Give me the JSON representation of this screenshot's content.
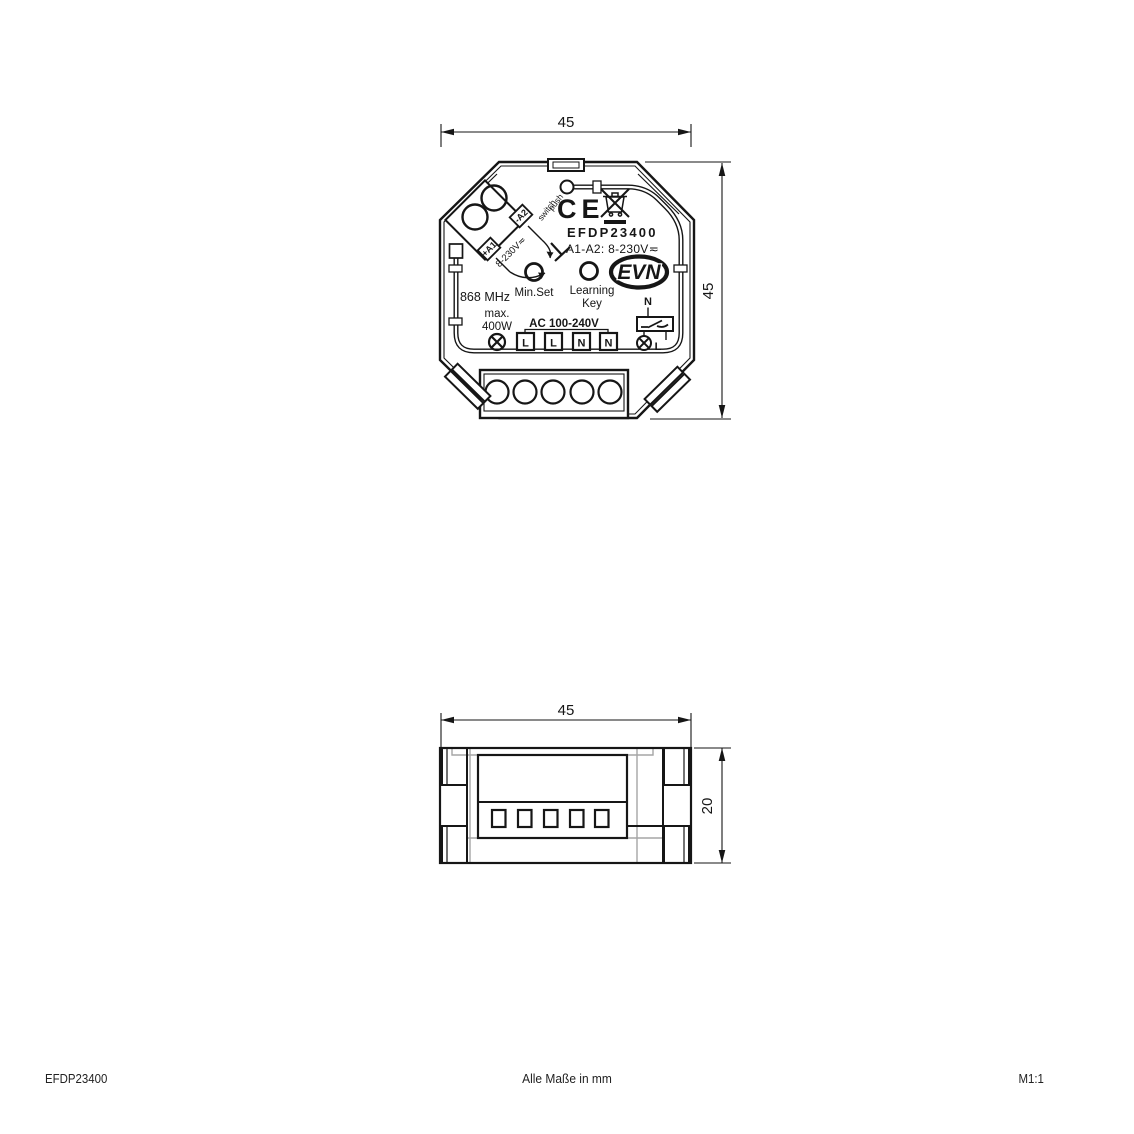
{
  "colors": {
    "ink": "#161616",
    "secondary_line": "#a6a6a6",
    "background": "#ffffff"
  },
  "top_view": {
    "dim_width": "45",
    "dim_height": "45",
    "ce_mark": "CE",
    "model": "EFDP23400",
    "input_rating": "A1-A2: 8-230V≂",
    "terminal_a2": "-A2",
    "terminal_a1": "+A1",
    "a_voltage": "8-230V≂",
    "push_label_1": "push",
    "push_label_2": "switch",
    "brand": "EVN",
    "min_set_label": "Min.Set",
    "learning_label_1": "Learning",
    "learning_label_2": "Key",
    "frequency": "868 MHz",
    "max_label": "max.",
    "power": "400W",
    "mains_label": "AC 100-240V",
    "mains_terminals": [
      "L",
      "L",
      "N",
      "N"
    ],
    "switched_neutral": "N",
    "switched_line": "L"
  },
  "side_view": {
    "dim_width": "45",
    "dim_height": "20"
  },
  "footer": {
    "product_code": "EFDP23400",
    "units_note": "Alle Maße in mm",
    "scale": "M1:1"
  }
}
